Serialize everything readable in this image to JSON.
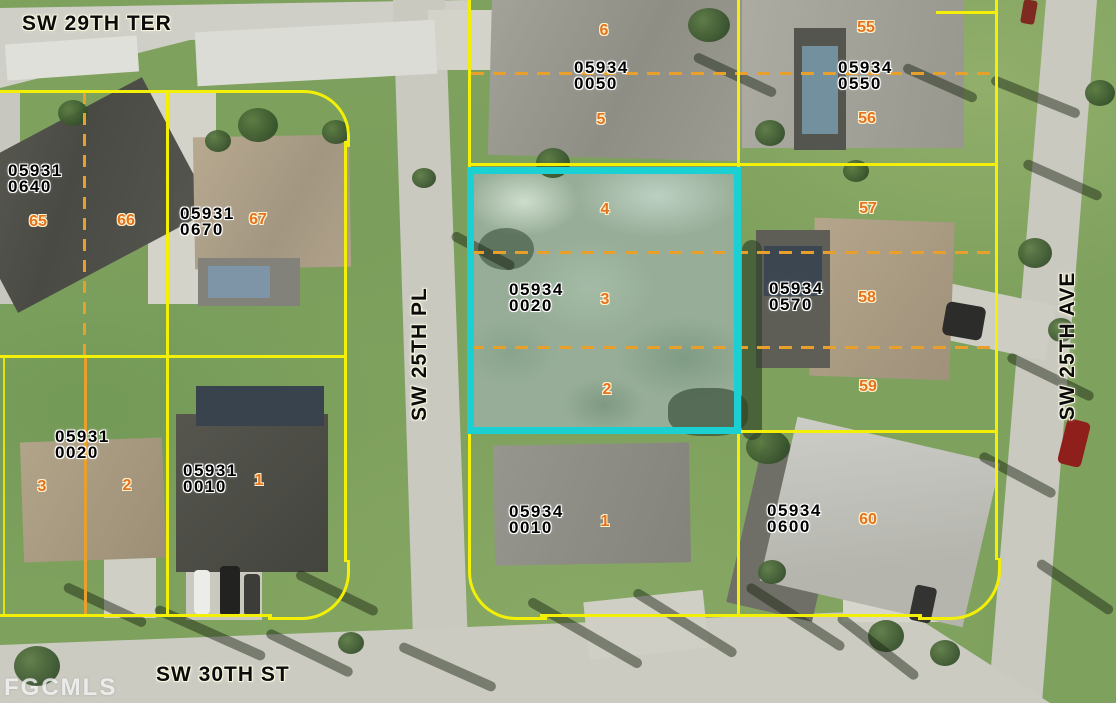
{
  "watermark": {
    "label": "FGCMLS"
  },
  "highlighted_parcel": "05934 0020",
  "colors": {
    "boundary": "#f3ef06",
    "lot_divider": "#e9a02a",
    "highlight": "#1bd0d3",
    "lot_number_text": "#e5731d",
    "parcel_text": "#000000",
    "street_text": "#0b0b0b"
  },
  "streets": [
    {
      "label": "SW 29TH TER",
      "x": 22,
      "y": 12,
      "vertical": false
    },
    {
      "label": "SW 25TH PL",
      "x": 420,
      "y": 354,
      "vertical": true
    },
    {
      "label": "SW 25TH AVE",
      "x": 1068,
      "y": 346,
      "vertical": true
    },
    {
      "label": "SW 30TH ST",
      "x": 156,
      "y": 663,
      "vertical": false
    }
  ],
  "parcels": [
    {
      "book": "05931",
      "page": "0640",
      "x": 8,
      "y": 163
    },
    {
      "book": "05931",
      "page": "0670",
      "x": 180,
      "y": 206
    },
    {
      "book": "05931",
      "page": "0020",
      "x": 55,
      "y": 429
    },
    {
      "book": "05931",
      "page": "0010",
      "x": 183,
      "y": 463
    },
    {
      "book": "05934",
      "page": "0050",
      "x": 574,
      "y": 60
    },
    {
      "book": "05934",
      "page": "0550",
      "x": 838,
      "y": 60
    },
    {
      "book": "05934",
      "page": "0020",
      "x": 509,
      "y": 282
    },
    {
      "book": "05934",
      "page": "0570",
      "x": 769,
      "y": 281
    },
    {
      "book": "05934",
      "page": "0010",
      "x": 509,
      "y": 504
    },
    {
      "book": "05934",
      "page": "0600",
      "x": 767,
      "y": 503
    }
  ],
  "lots": [
    {
      "n": "65",
      "x": 38,
      "y": 222
    },
    {
      "n": "66",
      "x": 126,
      "y": 221
    },
    {
      "n": "67",
      "x": 258,
      "y": 220
    },
    {
      "n": "3",
      "x": 42,
      "y": 487
    },
    {
      "n": "2",
      "x": 127,
      "y": 486
    },
    {
      "n": "1",
      "x": 259,
      "y": 481
    },
    {
      "n": "6",
      "x": 604,
      "y": 31
    },
    {
      "n": "5",
      "x": 601,
      "y": 120
    },
    {
      "n": "55",
      "x": 866,
      "y": 28
    },
    {
      "n": "56",
      "x": 867,
      "y": 119
    },
    {
      "n": "4",
      "x": 605,
      "y": 210
    },
    {
      "n": "3",
      "x": 605,
      "y": 300
    },
    {
      "n": "2",
      "x": 607,
      "y": 390
    },
    {
      "n": "57",
      "x": 868,
      "y": 209
    },
    {
      "n": "58",
      "x": 867,
      "y": 298
    },
    {
      "n": "59",
      "x": 868,
      "y": 387
    },
    {
      "n": "1",
      "x": 605,
      "y": 522
    },
    {
      "n": "60",
      "x": 868,
      "y": 520
    }
  ]
}
